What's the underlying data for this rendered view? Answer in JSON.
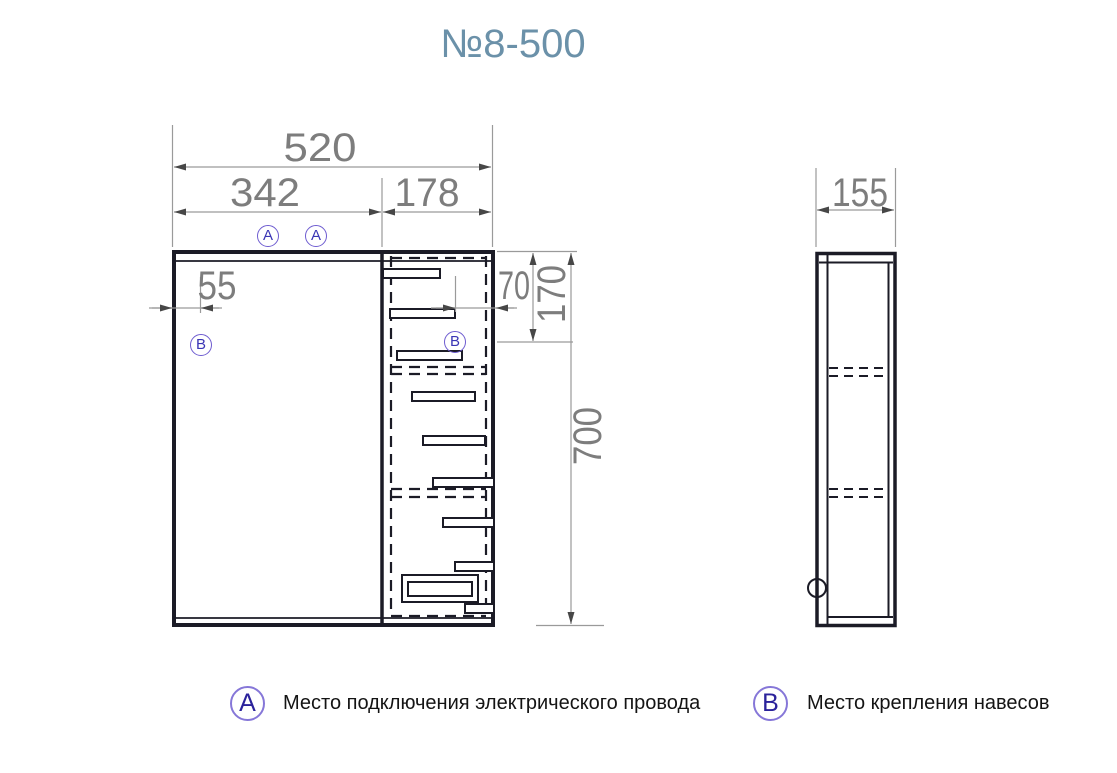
{
  "title": "№8-500",
  "markers": {
    "a": "A",
    "b": "B"
  },
  "front_view": {
    "dimensions": {
      "width_total": "520",
      "width_door": "342",
      "width_shelf_section": "178",
      "hanger_left_offset": "55",
      "hanger_right_offset": "70",
      "hanger_top_offset": "170",
      "height_total": "700"
    }
  },
  "side_view": {
    "dimensions": {
      "depth": "155"
    }
  },
  "legend": [
    {
      "marker": "A",
      "text": "Место подключения электрического провода"
    },
    {
      "marker": "B",
      "text": "Место крепления навесов"
    }
  ],
  "colors": {
    "line": "#1b1b26",
    "dimension": "#7d7d7d",
    "title": "#6b91a9",
    "marker": "#3a35b5"
  }
}
